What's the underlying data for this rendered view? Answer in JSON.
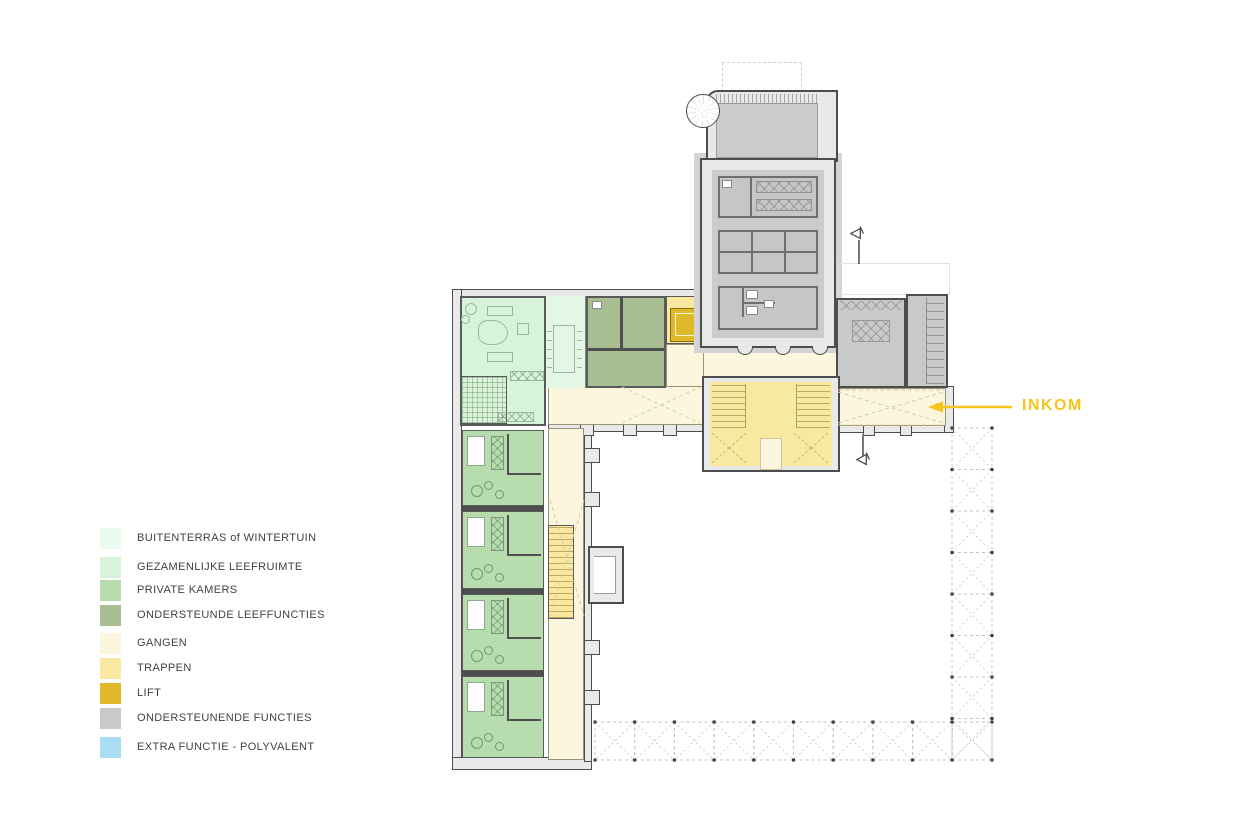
{
  "palette": {
    "accent": "#f3c51d",
    "wall": "#4d4d4d",
    "wall_fill": "#e9e9e9",
    "gray_interior": "#cbcbcb",
    "halo_gray": "#d4d4d4"
  },
  "legend": {
    "items": [
      {
        "label": "BUITENTERRAS of WINTERTUIN",
        "color": "#e9fbee"
      },
      {
        "label": "GEZAMENLIJKE LEEFRUIMTE",
        "color": "#d7f4da"
      },
      {
        "label": "PRIVATE KAMERS",
        "color": "#b7dcad"
      },
      {
        "label": "ONDERSTEUNDE LEEFFUNCTIES",
        "color": "#a9bd92"
      },
      {
        "label": "GANGEN",
        "color": "#fdf6df"
      },
      {
        "label": "TRAPPEN",
        "color": "#f9e8a0"
      },
      {
        "label": "LIFT",
        "color": "#e0b92a"
      },
      {
        "label": "ONDERSTEUNENDE FUNCTIES",
        "color": "#c9c9c9"
      },
      {
        "label": "EXTRA FUNCTIE - POLYVALENT",
        "color": "#a9ddf4"
      }
    ]
  },
  "annotations": {
    "entrance_label": "INKOM"
  }
}
